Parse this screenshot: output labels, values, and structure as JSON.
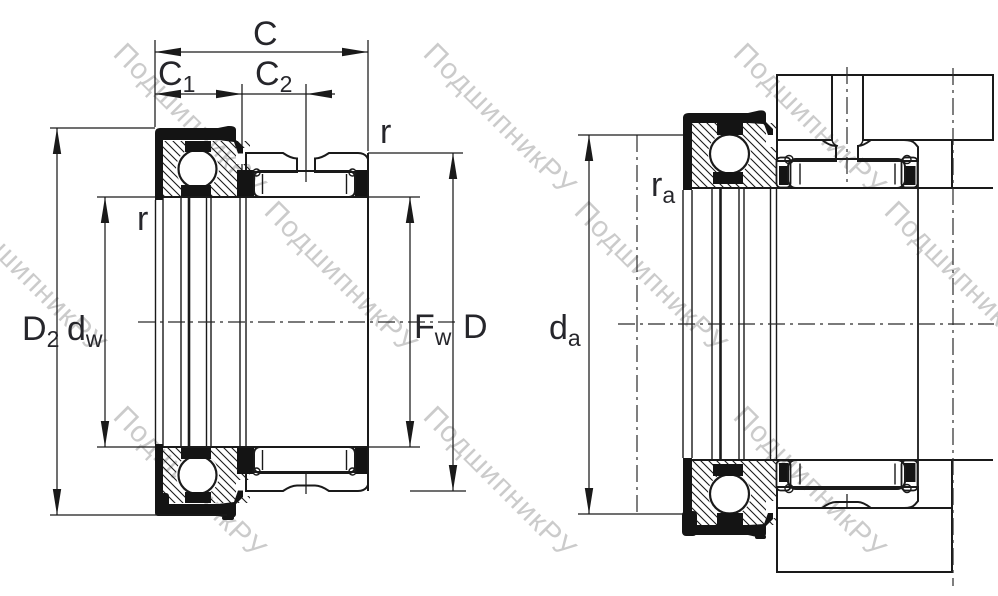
{
  "watermark": {
    "text": "ПодшипникРУ",
    "color": "#cbcbcb"
  },
  "drawing": {
    "line_color": "#1a1a1a",
    "label_color": "#26262b",
    "left_view": {
      "labels": {
        "c": "C",
        "c1_main": "C",
        "c1_sub": "1",
        "c2_main": "C",
        "c2_sub": "2",
        "r_upper": "r",
        "r_lower": "r",
        "d2_main": "D",
        "d2_sub": "2",
        "dw_main": "d",
        "dw_sub": "w",
        "fw_main": "F",
        "fw_sub": "w",
        "d": "D"
      }
    },
    "right_view": {
      "labels": {
        "ra_main": "r",
        "ra_sub": "a",
        "da_main": "d",
        "da_sub": "a"
      }
    }
  }
}
